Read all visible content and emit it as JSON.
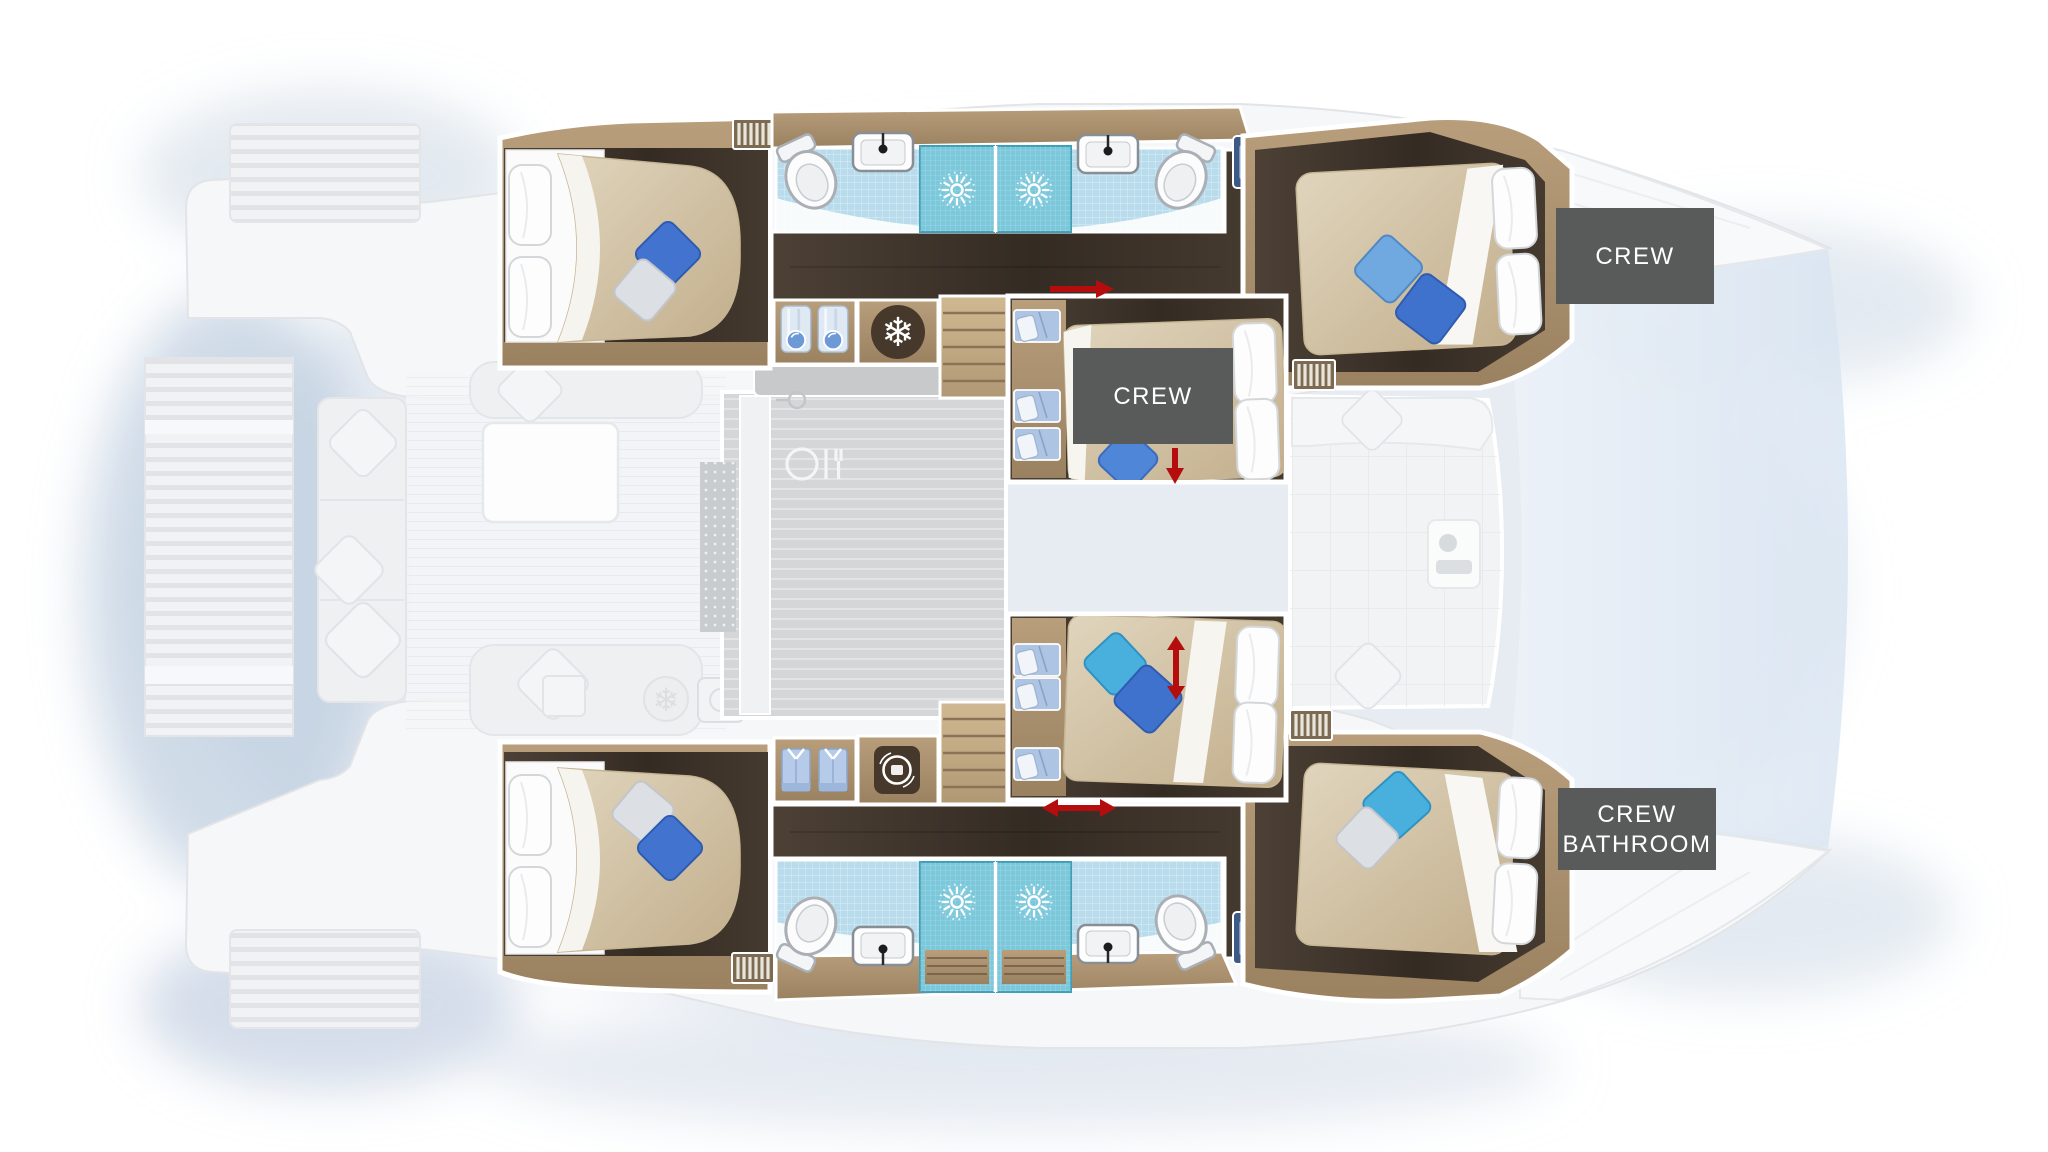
{
  "diagram": {
    "type": "catamaran-interior-floor-plan",
    "description": "Top-down deck plan of a sailing catamaran: four guest cabins with double beds, two central crew cabins, four bathrooms with showers, saloon, cockpit and bow trampolines",
    "labels": {
      "crew_fwd": {
        "text": "CREW",
        "bg": "#595a5a",
        "color": "#ffffff"
      },
      "crew_mid": {
        "text": "CREW",
        "bg": "#595a5a",
        "color": "#ffffff"
      },
      "crew_bathroom": {
        "line1": "CREW",
        "line2": "BATHROOM",
        "bg": "#595a5a",
        "color": "#ffffff"
      }
    },
    "icons": {
      "snowflake": {
        "name": "fridge-snowflake-icon",
        "glyph": "❄"
      },
      "shower": {
        "name": "shower-spray-icon"
      },
      "washer": {
        "name": "washing-machine-icon"
      },
      "dining": {
        "name": "dining-table-icon"
      },
      "toilet": {
        "name": "toilet-icon"
      },
      "sink": {
        "name": "washbasin-icon"
      },
      "basin": {
        "name": "double-washbasin-icon"
      },
      "shirt": {
        "name": "wardrobe-shirt-icon"
      },
      "bunk": {
        "name": "bunk-bed-icon"
      },
      "arrow": {
        "name": "sliding-door-arrow-icon"
      },
      "grille": {
        "name": "companionway-grille-icon"
      }
    },
    "colors": {
      "floor_dark": "#3a3028",
      "wood": "#a8906e",
      "wood_light": "#c3ab8a",
      "tile_floor": "#b9dcec",
      "tile_shower": "#7cc8db",
      "duvet_beige": "#d3c3a6",
      "pillow_royal_blue": "#3f72cc",
      "pillow_light_blue": "#6fa9e0",
      "pillow_turquoise": "#49b0dd",
      "pillow_silver": "#dcdfe3",
      "label_bg": "#595a5a",
      "arrow_red": "#b50d0d",
      "hull_faded": "#f5f6f7",
      "saloon_gray": "#d6d8d9",
      "shadow_blue": "#c3d0e2"
    }
  }
}
